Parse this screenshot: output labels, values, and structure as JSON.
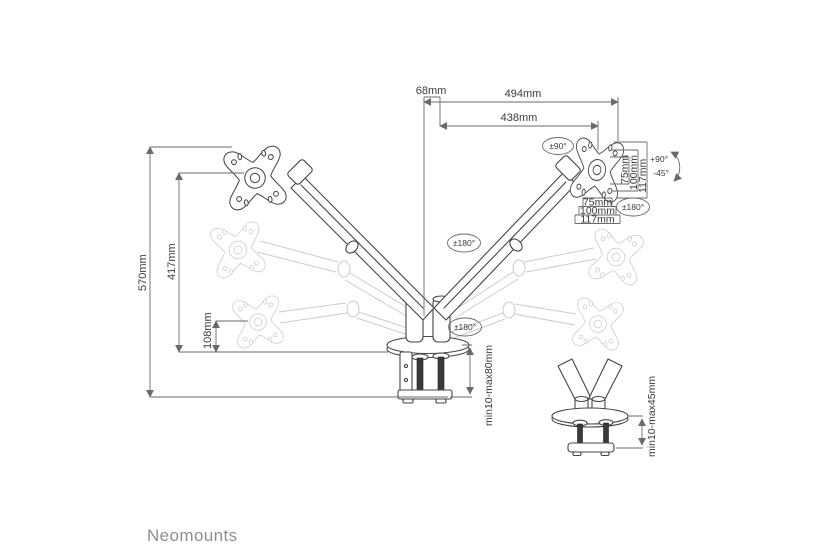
{
  "brand": {
    "logo": "Neomounts"
  },
  "diagram": {
    "product": "dual-monitor-desk-mount-arm",
    "colors": {
      "line": "#454545",
      "ghost": "#cccccc",
      "dimension": "#6a6a6a",
      "logo": "#8f8f8f"
    },
    "dims": {
      "offset": "68mm",
      "reach_full": "494mm",
      "reach_arm": "438mm",
      "height_max": "570mm",
      "height_mid": "417mm",
      "height_min": "108mm",
      "clamp_range": "min10-max80mm",
      "grommet_range": "min10-max45mm"
    },
    "vesa_vertical": [
      "75mm",
      "100mm",
      "117mm"
    ],
    "vesa_horizontal": [
      "75mm",
      "100mm",
      "117mm"
    ],
    "rotations": {
      "head_swivel": "±90°",
      "tilt_up": "+90°",
      "tilt_down": "-45°",
      "vesa_rotate": "±180°",
      "arm_rotate": "±180°",
      "base_rotate": "±180°"
    }
  }
}
